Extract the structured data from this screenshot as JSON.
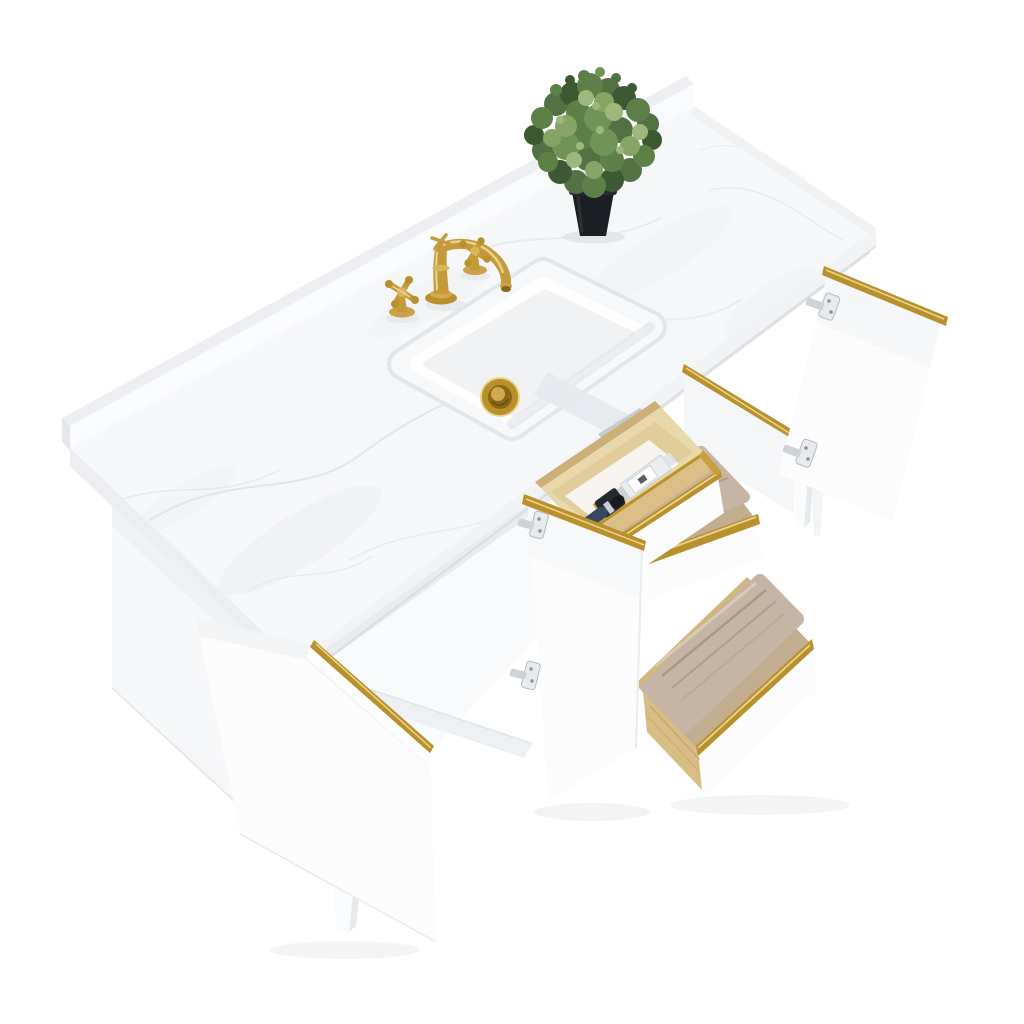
{
  "scene": {
    "subject": "Product photo of a freestanding bathroom vanity seen from a high three-quarter angle on a seamless white background",
    "vanity": {
      "cabinet_finish": "white",
      "trim_finish": "gold",
      "countertop": "white engineered marble with soft gray veining",
      "backsplash": "matching marble strip along back edge",
      "sink": "white rectangular undermount basin",
      "drain_finish": "gold pop-up drain",
      "faucet": "gold widespread faucet with curved spout and two cross handles",
      "hinges": "polished chrome concealed hinges",
      "feet": "tapered white wood feet"
    },
    "counts": {
      "open_doors": 3,
      "open_drawers": 3,
      "towels": 2,
      "faucet_handles": 2,
      "visible_feet": 3
    },
    "contents": {
      "top_drawer": [
        "pine organizer tray",
        "clear perfume bottle with black cap",
        "dark blue brush handle"
      ],
      "middle_drawer": [
        "folded taupe towel"
      ],
      "bottom_drawer": [
        "folded taupe towel"
      ],
      "countertop_decor": [
        "green faux plant in black tapered pot"
      ]
    },
    "drawer_boxes": "natural pine wood with gold edge trim on fronts"
  },
  "colors": {
    "background": "#ffffff",
    "gold": "#b8902c",
    "gold_light": "#f0dc9b",
    "gold_dark": "#8a6618",
    "marble": "#f6f7f9",
    "marble_vein": "#dfe3e8",
    "cabinet_white": "#fcfcfd",
    "cabinet_shadow": "#e9ebee",
    "wood": "#e9d8ab",
    "wood_dark": "#cfae74",
    "towel": "#c6b4a5",
    "towel_shadow": "#a38e7a",
    "chrome": "#d9dce0",
    "pot": "#1b1e22",
    "leaf": "#527244",
    "interior_floor": "#c3ad8f"
  }
}
